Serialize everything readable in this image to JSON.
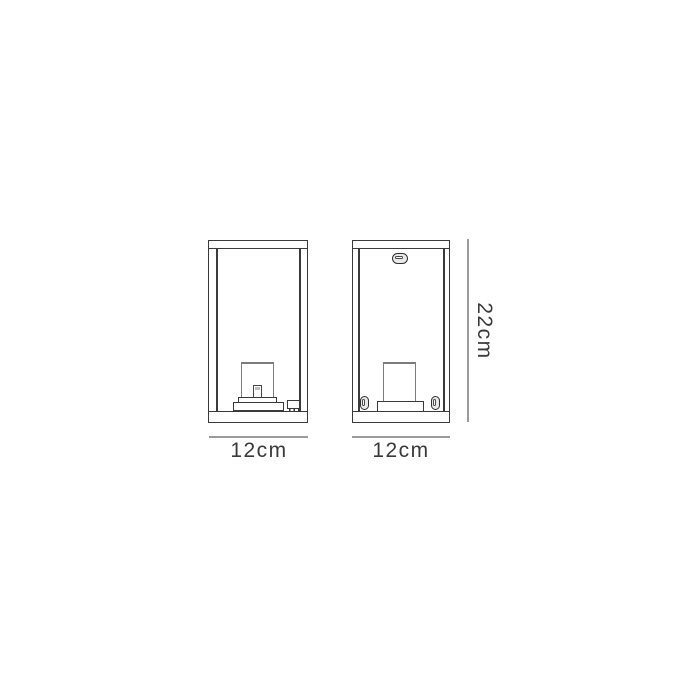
{
  "diagram": {
    "title": "box lantern wall light dimension drawing",
    "colors": {
      "background": "#ffffff",
      "outline": "#3a3a3a",
      "socket_outline": "#7d7d7d",
      "dimension_line": "#9b9b9b",
      "label_text": "#3a3a3a"
    },
    "views": {
      "front": {
        "width_label": "12cm"
      },
      "rear": {
        "width_label": "12cm"
      }
    },
    "height_label": "22cm"
  }
}
